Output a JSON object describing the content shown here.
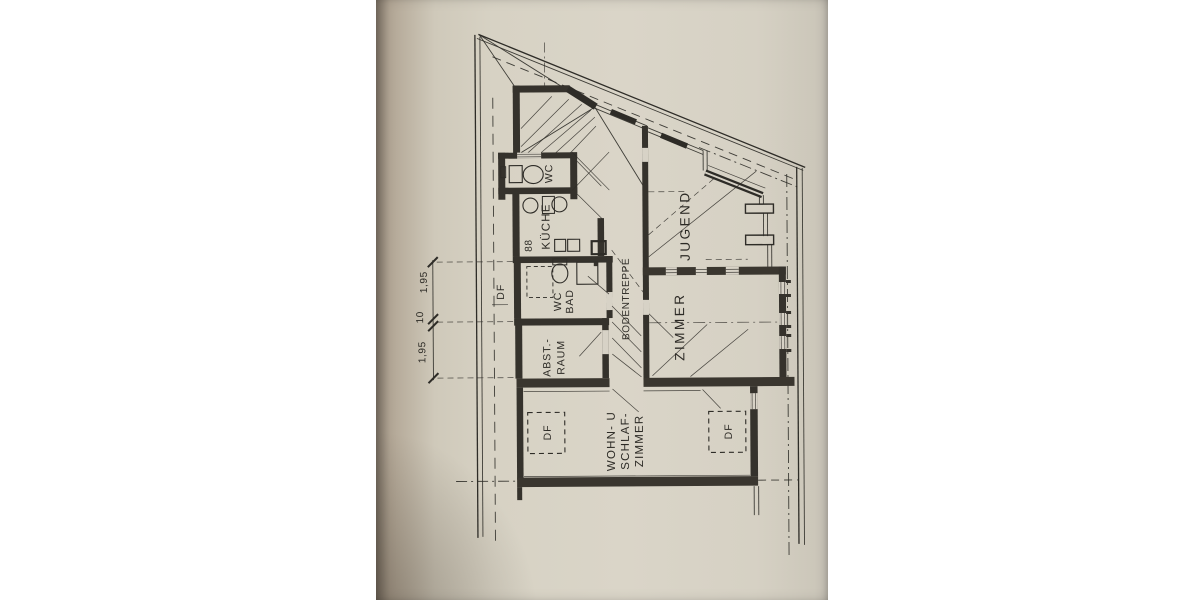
{
  "scan": {
    "kind": "scanned floor plan photograph",
    "language": "de",
    "paper_color": "#d7d2c5",
    "ink_color": "#2e2c27",
    "backdrop_color": "#ffffff"
  },
  "labels": {
    "wc": "WC",
    "kueche": "KÜCHE",
    "wc_bad": [
      "WC",
      "BAD"
    ],
    "abstellraum": [
      "ABST.-",
      "RAUM"
    ],
    "bodentreppe": "BODENTREPPE",
    "jugendzimmer": [
      "JUGEND",
      "ZIMMER"
    ],
    "wohn_schlafzimmer": [
      "WOHN- U",
      "SCHLAF-",
      "ZIMMER"
    ],
    "stove_symbol": "88"
  },
  "roof_windows": [
    {
      "id": "df-eave-left",
      "label": "DF"
    },
    {
      "id": "df-wohnzimmer-left",
      "label": "DF"
    },
    {
      "id": "df-wohnzimmer-right",
      "label": "DF"
    }
  ],
  "dimensions": [
    {
      "label": "1,95"
    },
    {
      "label": "10"
    },
    {
      "label": "1,95"
    }
  ]
}
